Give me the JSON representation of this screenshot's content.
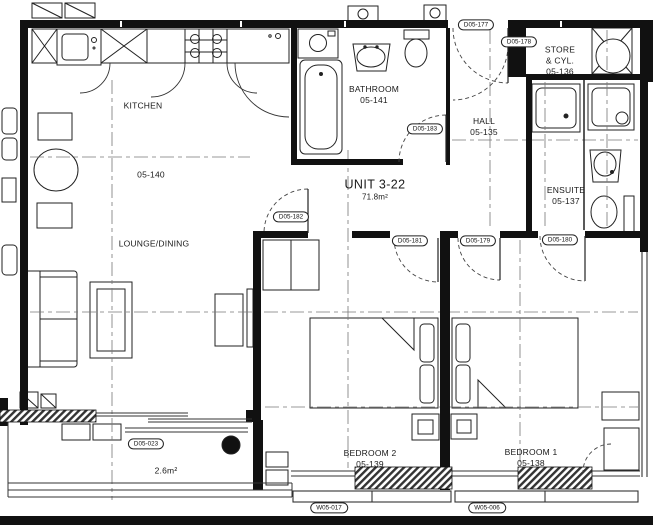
{
  "unit": {
    "name": "UNIT 3-22",
    "area": "71.8m²"
  },
  "rooms": {
    "kitchen": {
      "name": "KITCHEN",
      "number": "05-140"
    },
    "lounge": {
      "name": "LOUNGE/DINING"
    },
    "bathroom": {
      "name": "BATHROOM",
      "number": "05-141"
    },
    "hall": {
      "name": "HALL",
      "number": "05-135"
    },
    "store": {
      "name": "STORE",
      "name2": "& CYL.",
      "number": "05-136"
    },
    "ensuite": {
      "name": "ENSUITE",
      "number": "05-137"
    },
    "bedroom2": {
      "name": "BEDROOM 2",
      "number": "05-139"
    },
    "bedroom1": {
      "name": "BEDROOM 1",
      "number": "05-138"
    },
    "balcony": {
      "area": "2.6m²"
    }
  },
  "tags": {
    "d177": "D05-177",
    "d178": "D05-178",
    "d183": "D05-183",
    "d182": "D05-182",
    "d181": "D05-181",
    "d179": "D05-179",
    "d180": "D05-180",
    "d023": "D05-023",
    "w017": "W05-017",
    "w006": "W05-006"
  },
  "colors": {
    "line": "#1a1a1a",
    "background": "#ffffff"
  }
}
